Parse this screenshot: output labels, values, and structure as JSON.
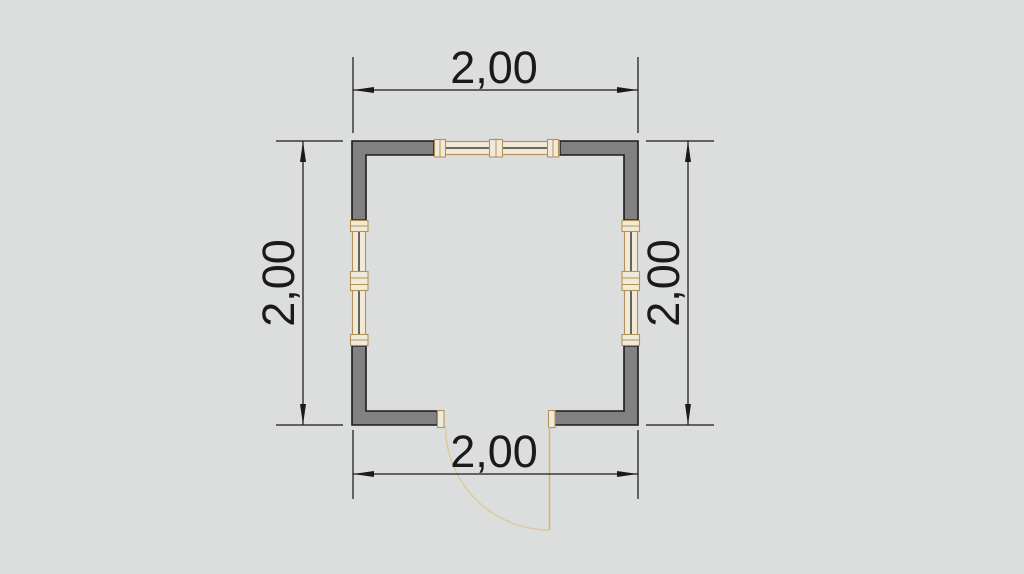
{
  "drawing": {
    "type": "floor-plan",
    "room_shape": "square",
    "features": [
      "walls",
      "window-top",
      "window-left",
      "window-right",
      "door-bottom-with-swing-arc"
    ]
  },
  "dimension_labels": {
    "top": "2,00",
    "bottom": "2,00",
    "left": "2,00",
    "right": "2,00"
  },
  "colors": {
    "background": "#dcdddd",
    "wall": "#818181",
    "wall_outline": "#1b1b1b",
    "dim": "#1a1a1a",
    "frame": "#b3925a",
    "frame_fill": "#f1ead9",
    "door": "#d3b27c",
    "door_arc": "#dcc795"
  }
}
